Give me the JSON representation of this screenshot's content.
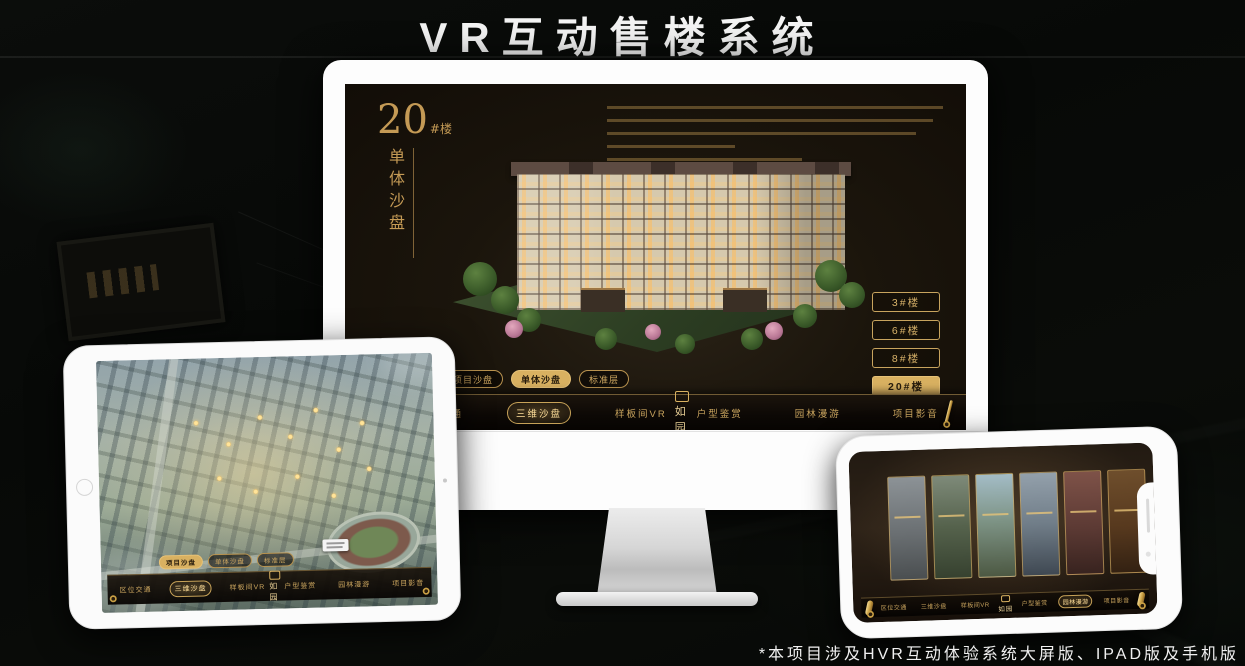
{
  "title": "VR互动售楼系统",
  "footnote": "*本项目涉及HVR互动体验系统大屏版、IPAD版及手机版",
  "colors": {
    "gold": "#d9b161",
    "gold_text": "#c9a45e",
    "screen_bg": "#171209"
  },
  "monitor": {
    "badge": {
      "number": "20",
      "suffix": "#楼",
      "subtitle": "单体沙盘"
    },
    "floor_buttons": [
      {
        "label": "3#楼"
      },
      {
        "label": "6#楼"
      },
      {
        "label": "8#楼"
      },
      {
        "label": "20#楼"
      }
    ],
    "tabs": [
      {
        "label": "项目沙盘"
      },
      {
        "label": "单体沙盘"
      },
      {
        "label": "标准层"
      }
    ],
    "nav": {
      "items": [
        "区位交通",
        "三维沙盘",
        "样板间VR",
        "户型鉴赏",
        "园林漫游",
        "项目影音"
      ],
      "logo": "如园"
    }
  },
  "tablet": {
    "tabs": [
      {
        "label": "项目沙盘"
      },
      {
        "label": "单体沙盘"
      },
      {
        "label": "标准层"
      }
    ],
    "nav": {
      "items": [
        "区位交通",
        "三维沙盘",
        "样板间VR",
        "户型鉴赏",
        "园林漫游",
        "项目影音"
      ],
      "logo": "如园"
    }
  },
  "phone": {
    "nav": {
      "items": [
        "区位交通",
        "三维沙盘",
        "样板间VR",
        "户型鉴赏",
        "园林漫游",
        "项目影音"
      ],
      "logo": "如园"
    }
  }
}
